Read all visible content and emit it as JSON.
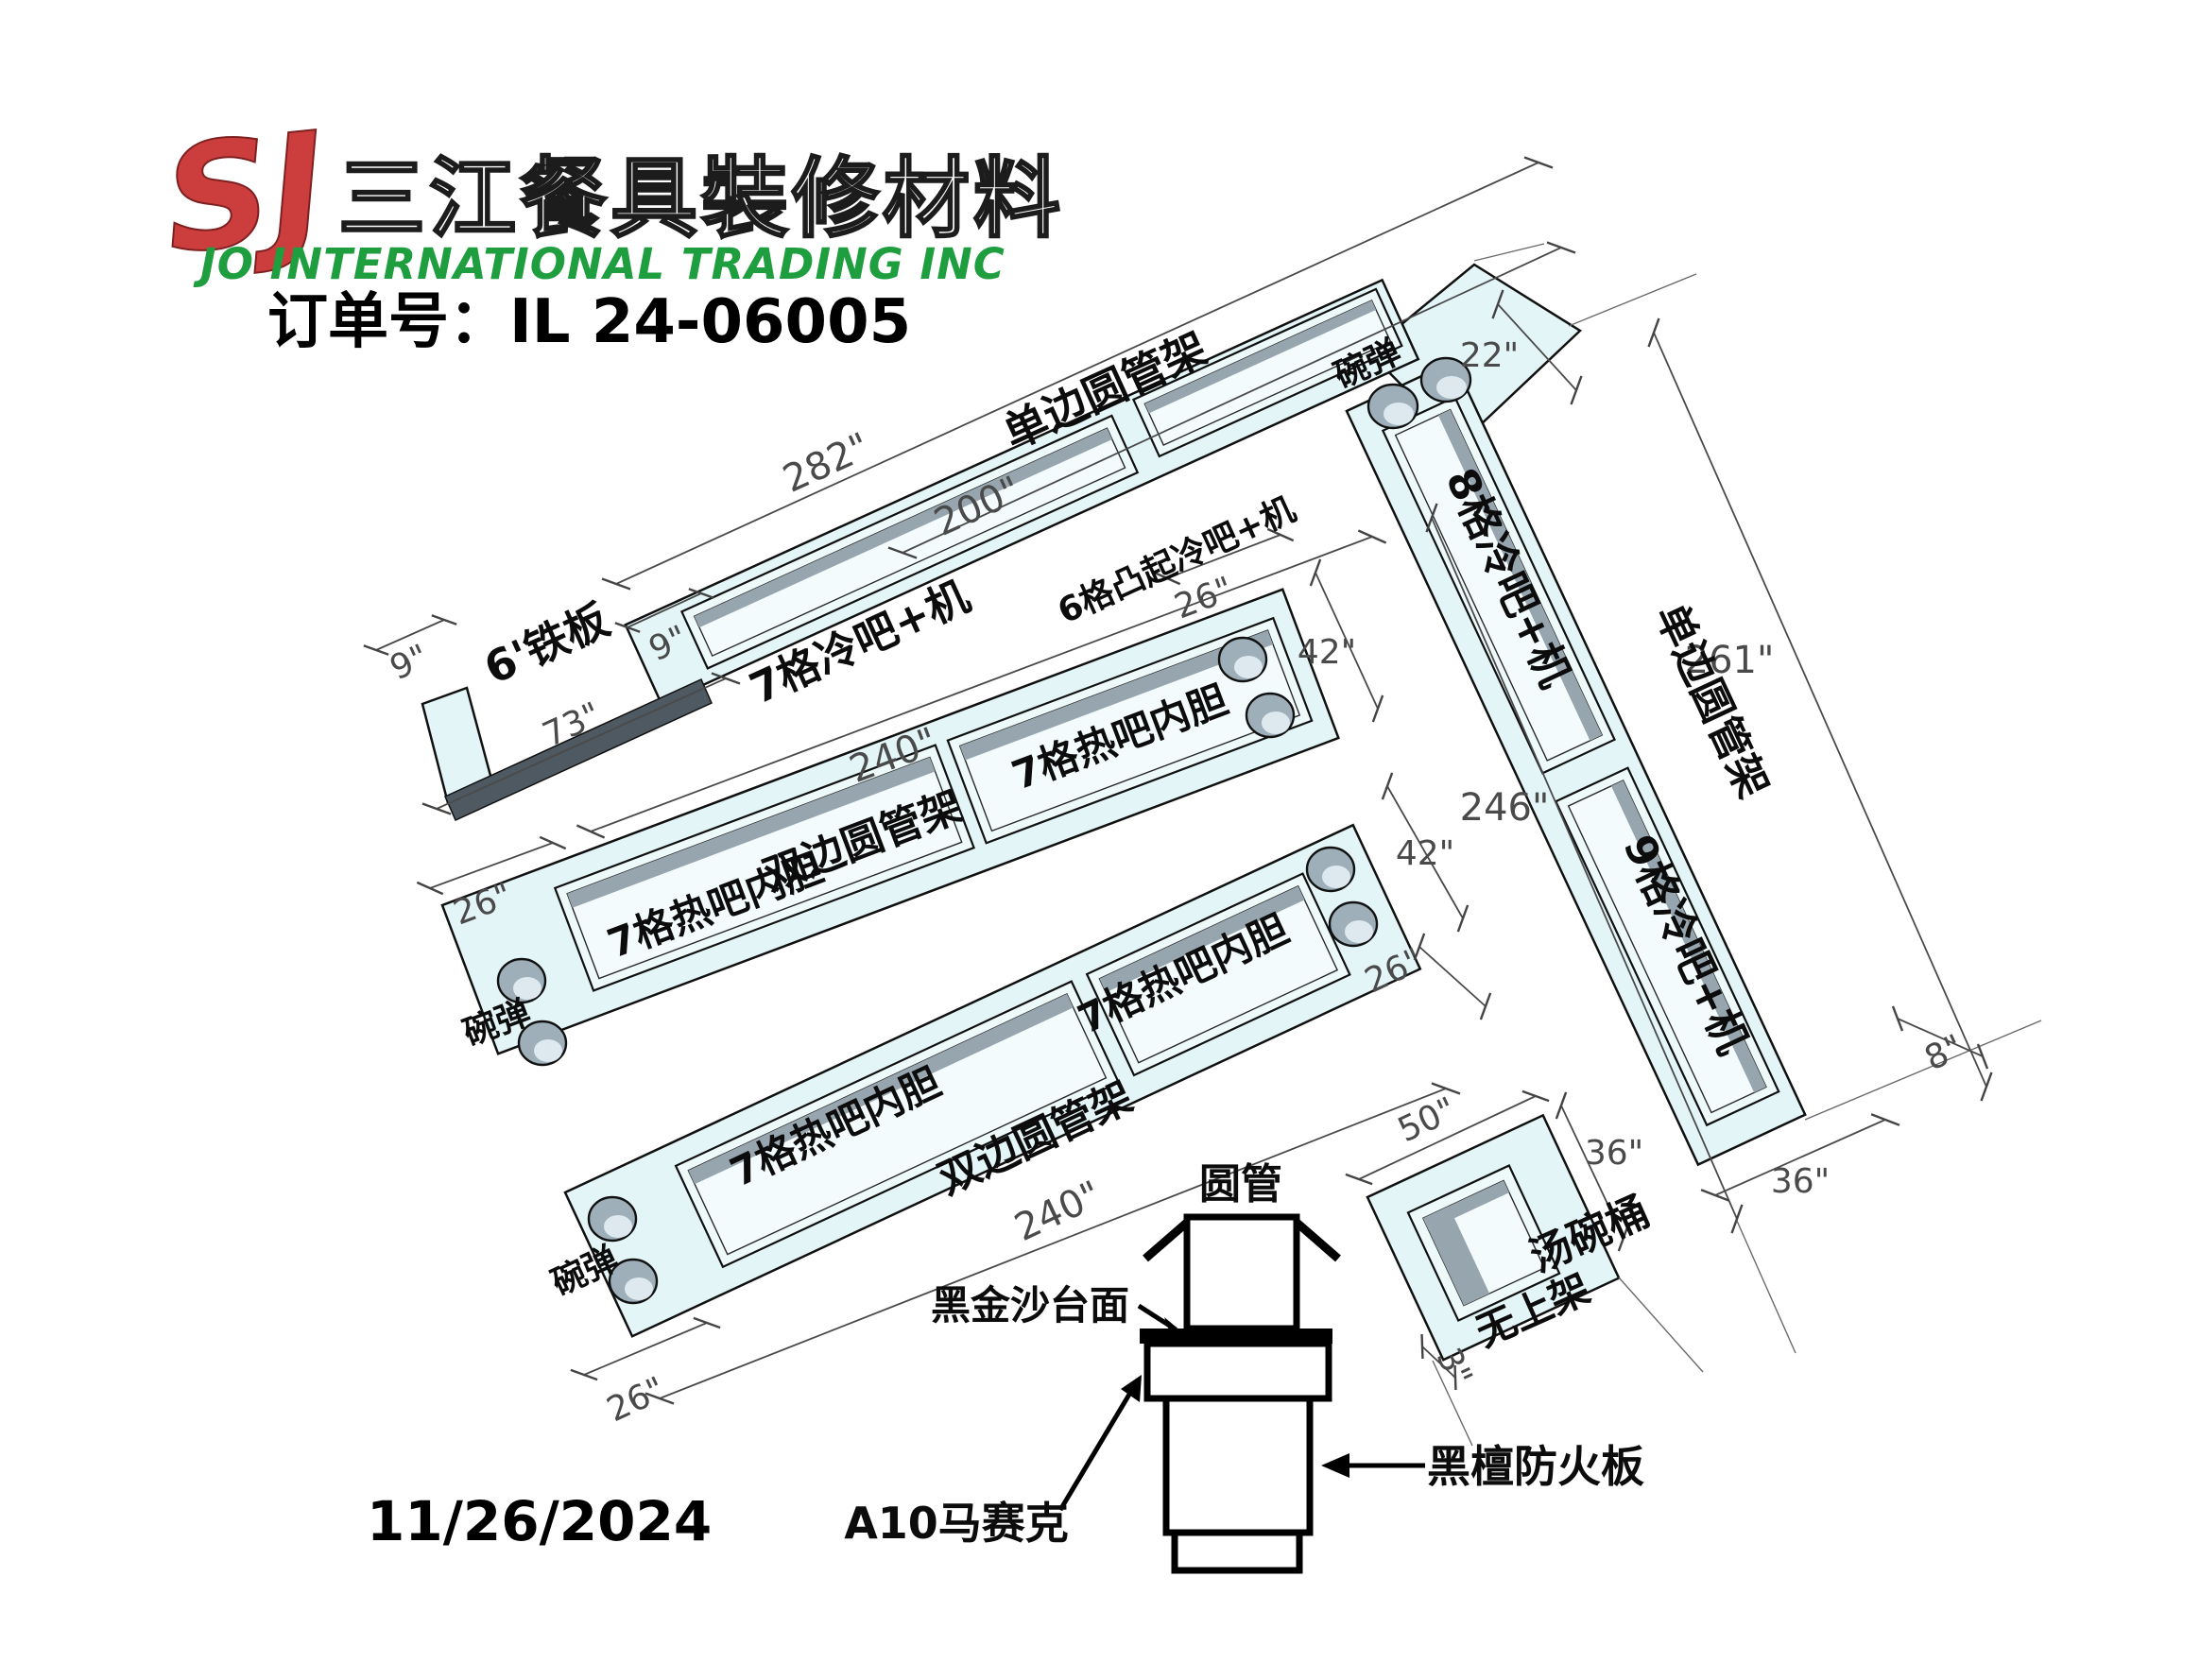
{
  "header": {
    "logo_mark": "SJ",
    "company_cn": "三江餐具裝修材料",
    "company_en": "JO INTERNATIONAL TRADING INC",
    "order_no": "订单号：IL 24-06005"
  },
  "date": "11/26/2024",
  "colors": {
    "counter_fill": "#e3f5f7",
    "well_shadow": "#97a5af",
    "hole_fill": "#9eafb9",
    "iron_plate": "#4e5962",
    "dim_gray": "#4a4a4a",
    "logo_red": "#cc3d3d",
    "logo_green": "#1e9e3e"
  },
  "labels": {
    "rack_single": "单边圆管架",
    "rack_double": "双边圆管架",
    "cold7": "7格冷吧+机",
    "cold6_raised": "6格凸起冷吧+机",
    "cold8": "8格冷吧+机",
    "cold9": "9格冷吧+机",
    "hot7_liner": "7格热吧内胆",
    "bowl_spring": "碗弹",
    "iron_plate": "6'铁板",
    "round_tube": "圆管",
    "countertop": "黑金沙台面",
    "mosaic": "A10马赛克",
    "fireboard": "黑檀防火板",
    "soup_bucket": "汤碗桶",
    "no_top_rack": "无上架"
  },
  "dims": {
    "d282": "282\"",
    "d200": "200\"",
    "d9": "9\"",
    "d73": "73\"",
    "d22": "22\"",
    "d261": "261\"",
    "d246": "246\"",
    "d8": "8\"",
    "d36": "36\"",
    "d50": "50\"",
    "d3": "3\"",
    "d240": "240\"",
    "d26": "26\"",
    "d42": "42\""
  }
}
